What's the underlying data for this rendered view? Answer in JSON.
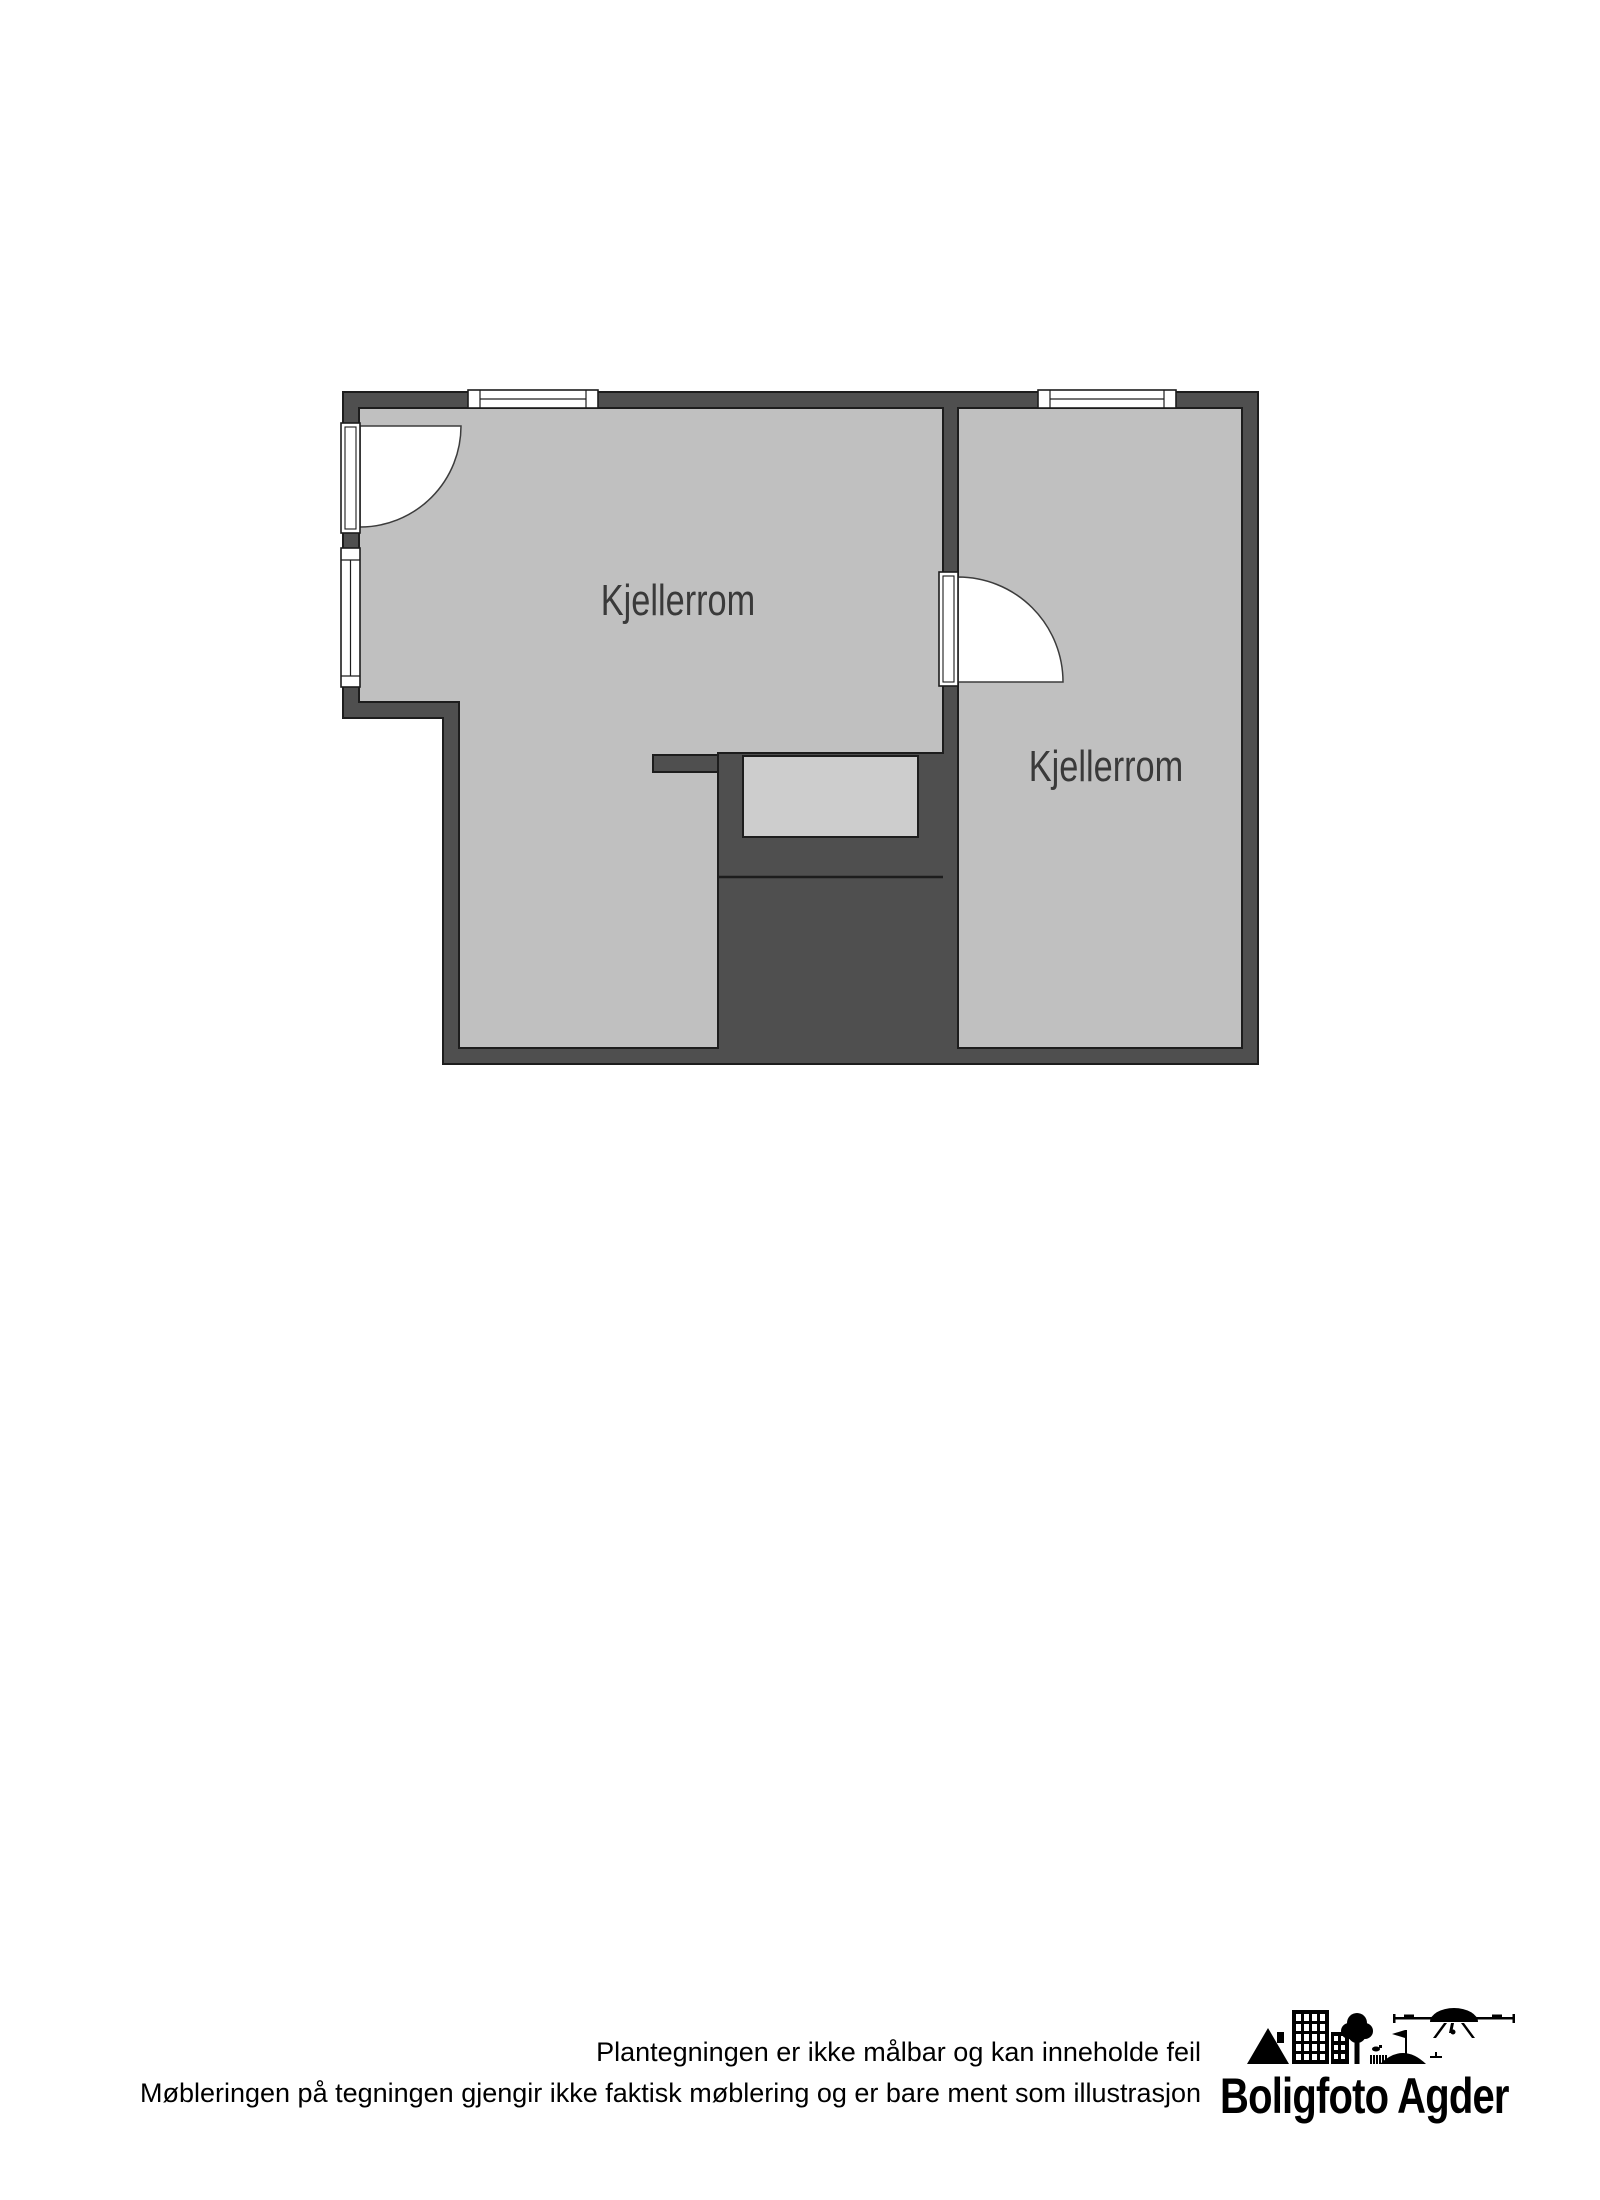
{
  "floorplan": {
    "rooms": [
      {
        "label": "Kjellerrom"
      },
      {
        "label": "Kjellerrom"
      }
    ]
  },
  "footer": {
    "disclaimer_line1": "Plantegningen er ikke målbar og kan inneholde feil",
    "disclaimer_line2": "Møbleringen på tegningen gjengir ikke faktisk møblering og er bare ment som illustrasjon"
  },
  "logo": {
    "brand": "Boligfoto Agder"
  },
  "colors": {
    "page_bg": "#ffffff",
    "wall": "#4f4f4f",
    "floor": "#c0c0c0",
    "landing": "#cdcdcd",
    "outline": "#1d1d1d",
    "room_label": "#3a3a3a"
  }
}
